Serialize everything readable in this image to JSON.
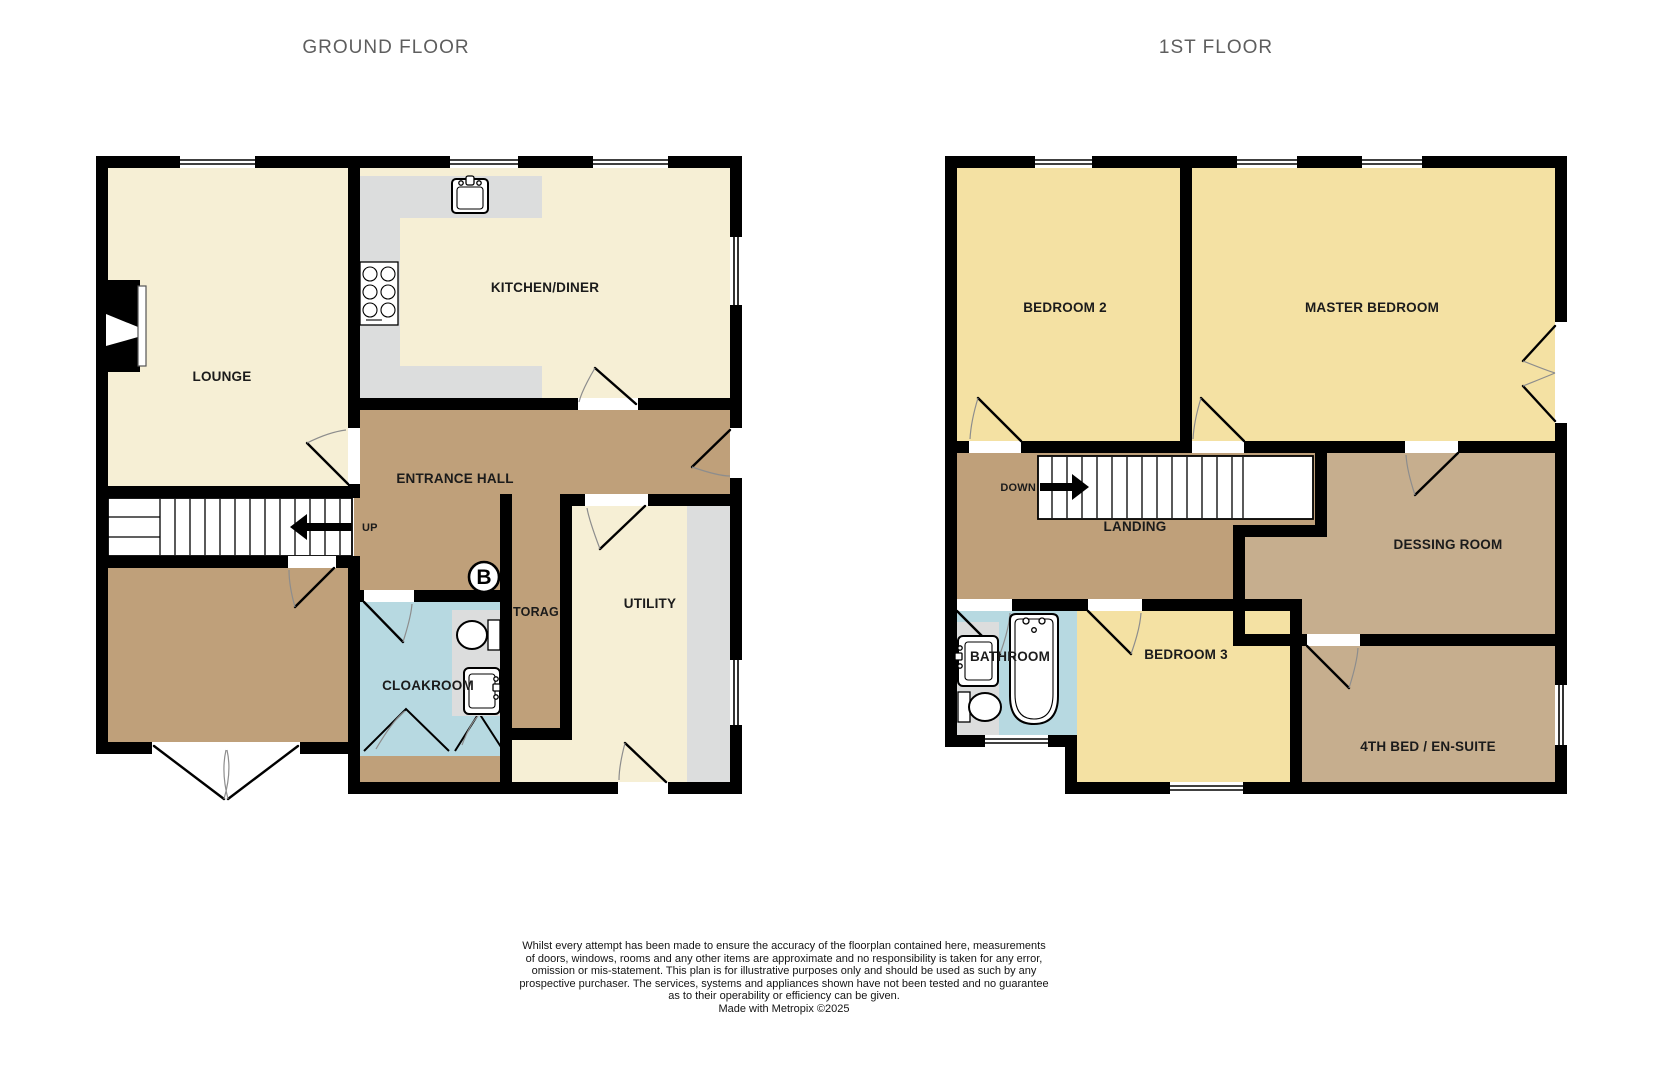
{
  "titles": {
    "ground": "GROUND FLOOR",
    "first": "1ST FLOOR"
  },
  "ground_floor": {
    "rooms": {
      "lounge": "LOUNGE",
      "kitchen": "KITCHEN/DINER",
      "hall": "ENTRANCE HALL",
      "cloakroom": "CLOAKROOM",
      "storage": "TORAG",
      "utility": "UTILITY"
    },
    "stairs_label": "UP",
    "boiler_symbol": "B"
  },
  "first_floor": {
    "rooms": {
      "bedroom2": "BEDROOM 2",
      "master": "MASTER BEDROOM",
      "landing": "LANDING",
      "dressing": "DESSING ROOM",
      "bathroom": "BATHROOM",
      "bedroom3": "BEDROOM 3",
      "bed4": "4TH BED / EN-SUITE"
    },
    "stairs_label": "DOWN"
  },
  "disclaimer": {
    "line1": "Whilst every attempt has been made to ensure the accuracy of the floorplan contained here, measurements",
    "line2": "of doors, windows, rooms and any other items are approximate and no responsibility is taken for any error,",
    "line3": "omission or mis-statement. This plan is for illustrative purposes only and should be used as such by any",
    "line4": "prospective purchaser. The services, systems and appliances shown have not been tested and no guarantee",
    "line5": "as to their operability or efficiency can be given.",
    "credit": "Made with Metropix ©2025"
  },
  "colors": {
    "wall": "#000000",
    "cream_floor": "#f6efd5",
    "yellow_floor": "#f4e1a3",
    "brown_floor": "#bfa07a",
    "tan_floor": "#c6ae8e",
    "blue_floor": "#b7d9e1",
    "counter_grey": "#dcdddd",
    "title_text": "#5e5e5e",
    "label_text": "#1b1b1b"
  }
}
